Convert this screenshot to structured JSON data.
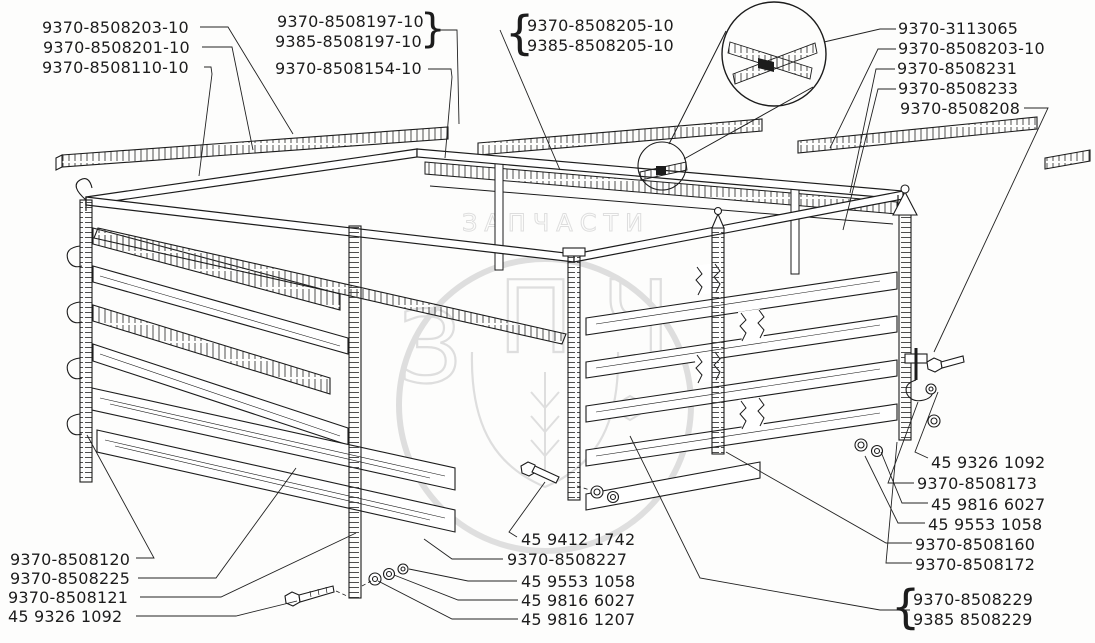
{
  "figure": {
    "type": "exploded-parts-diagram",
    "subject": "Lattice stake platform body with part-number callouts",
    "colors": {
      "ink": "#1c1c1c",
      "watermark": "#c6c6c6",
      "paper": "#fdfdfc"
    },
    "watermark": {
      "letters": [
        "З",
        "П",
        "Ч"
      ],
      "arc_text": "ЗАПЧАСТИ"
    },
    "braces": [
      "}",
      "{",
      "{"
    ],
    "labels": [
      {
        "text": "9370-8508203-10"
      },
      {
        "text": "9370-8508201-10"
      },
      {
        "text": "9370-8508110-10"
      },
      {
        "text": "9370-8508197-10"
      },
      {
        "text": "9385-8508197-10"
      },
      {
        "text": "9370-8508154-10"
      },
      {
        "text": "9370-8508205-10"
      },
      {
        "text": "9385-8508205-10"
      },
      {
        "text": "9370-3113065"
      },
      {
        "text": "9370-8508203-10"
      },
      {
        "text": "9370-8508231"
      },
      {
        "text": "9370-8508233"
      },
      {
        "text": "9370-8508208"
      },
      {
        "text": "45 9326 1092"
      },
      {
        "text": "9370-8508173"
      },
      {
        "text": "45 9816 6027"
      },
      {
        "text": "45 9553 1058"
      },
      {
        "text": "9370-8508160"
      },
      {
        "text": "9370-8508172"
      },
      {
        "text": "9370-8508229"
      },
      {
        "text": "9385 8508229"
      },
      {
        "text": "45 9412 1742"
      },
      {
        "text": "9370-8508227"
      },
      {
        "text": "45 9553 1058"
      },
      {
        "text": "45 9816 6027"
      },
      {
        "text": "45 9816 1207"
      },
      {
        "text": "9370-8508120"
      },
      {
        "text": "9370-8508225"
      },
      {
        "text": "9370-8508121"
      },
      {
        "text": "45 9326 1092"
      }
    ]
  }
}
